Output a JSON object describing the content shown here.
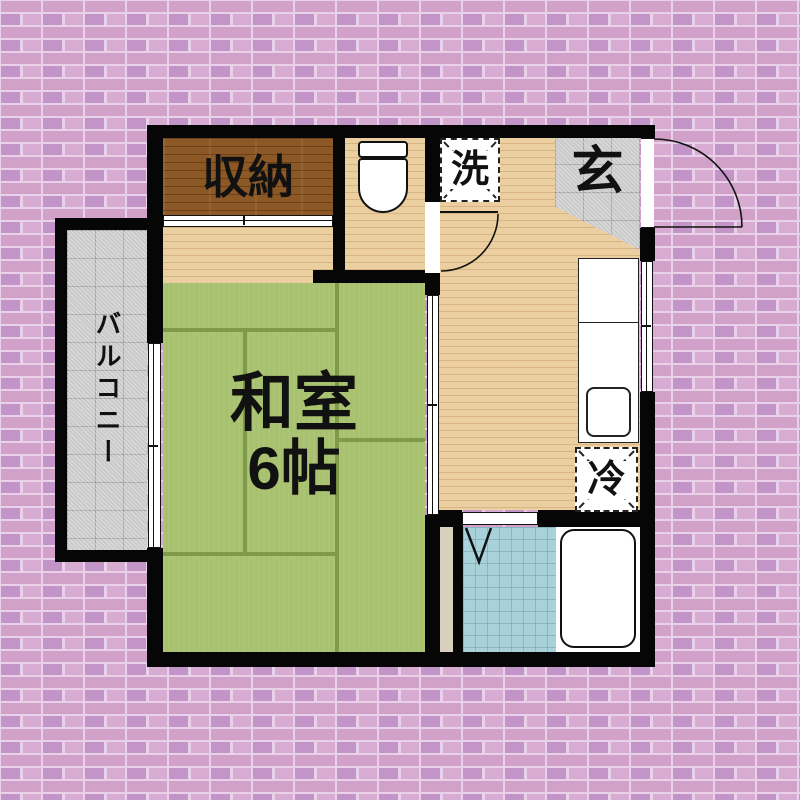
{
  "floorplan": {
    "rooms": {
      "storage": {
        "label": "収納"
      },
      "washer_space": {
        "label": "洗"
      },
      "entrance": {
        "label": "玄"
      },
      "japanese_room": {
        "name": "和室",
        "size": "6帖"
      },
      "balcony": {
        "label": "バルコニー"
      },
      "refrigerator_space": {
        "label": "冷"
      }
    },
    "colors": {
      "wall": "#060606",
      "brick_mortar": "#e9d2e9",
      "brick_a": "#d2a1ca",
      "brick_b": "#c394c8",
      "brick_c": "#d8abd2",
      "wood_light": "#eccfa0",
      "wood_dark": "#8c5826",
      "tatami": "#a8c16e",
      "tatami_line": "#7f9a4b",
      "tile_gray": "#cacaca",
      "bath_tile": "#a8d1d9",
      "ps_beige": "#d6d0bd",
      "white": "#ffffff"
    }
  }
}
